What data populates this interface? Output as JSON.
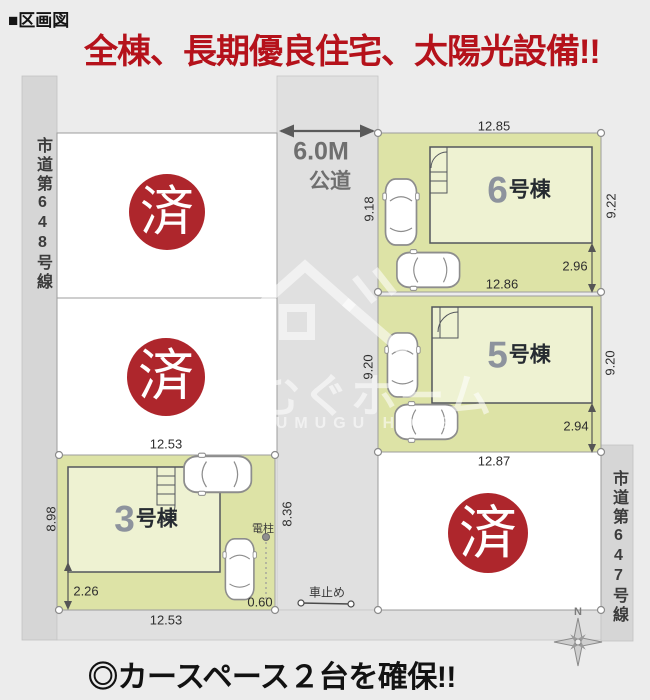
{
  "header": {
    "section": "■区画図",
    "headline": "全棟、長期優良住宅、太陽光設備!!"
  },
  "roads": {
    "left_label": "市道第648号線",
    "right_label": "市道第647号線",
    "front_width": "6.0M",
    "front_type": "公道"
  },
  "lots": {
    "lot1": {
      "status": "済"
    },
    "lot2": {
      "status": "済"
    },
    "lot4": {
      "status": "済"
    },
    "lot3": {
      "num": "3",
      "suffix": "号棟",
      "dim_top": "12.53",
      "dim_bottom": "12.53",
      "dim_left": "8.98",
      "dim_right": "8.36",
      "dim_setback": "2.26",
      "dim_corner": "0.60"
    },
    "lot5": {
      "num": "5",
      "suffix": "号棟",
      "dim_left": "9.20",
      "dim_right": "9.20",
      "dim_bottom": "12.87",
      "dim_setback": "2.94"
    },
    "lot6": {
      "num": "6",
      "suffix": "号棟",
      "dim_top": "12.85",
      "dim_bottom": "12.86",
      "dim_left": "9.18",
      "dim_right": "9.22",
      "dim_setback": "2.96"
    }
  },
  "markers": {
    "utility_pole": "電柱",
    "car_stop": "車止め",
    "north": "N"
  },
  "watermark": {
    "name": "つむぐホーム",
    "name_en": "TSUMUGU HOME"
  },
  "footer": {
    "note": "◎カースペース２台を確保!!"
  },
  "colors": {
    "accent_red": "#b5121b",
    "sold_red": "#ae262c",
    "lot_green": "#dde3a6",
    "building_fill": "#eef2d2"
  }
}
